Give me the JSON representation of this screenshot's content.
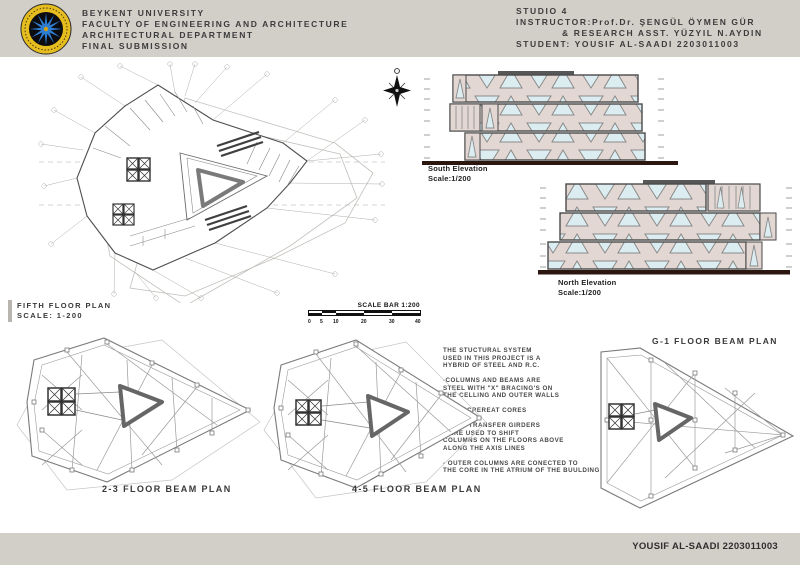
{
  "header": {
    "logo_name": "beykent-university-seal",
    "university": "BEYKENT UNIVERSITY",
    "faculty": "FACULTY OF ENGINEERING AND ARCHITECTURE",
    "department": "ARCHITECTURAL DEPARTMENT",
    "submission": "FINAL SUBMISSION",
    "studio": "STUDIO 4",
    "instructor": "INSTRUCTOR:Prof.Dr. ŞENGÜL ÖYMEN GÜR",
    "instructor_assistant": "& RESEARCH ASST. YÜZYIL N.AYDIN",
    "student": "STUDENT: YOUSIF AL-SAADI 2203011003"
  },
  "drawings": {
    "floor_plan": {
      "title": "FIFTH FLOOR PLAN",
      "scale": "SCALE: 1-200"
    },
    "south_elevation": {
      "title": "South Elevation",
      "scale": "Scale:1/200"
    },
    "north_elevation": {
      "title": "North Elevation",
      "scale": "Scale:1/200"
    },
    "beam_plan_23": {
      "title": "2-3 FLOOR BEAM PLAN"
    },
    "beam_plan_45": {
      "title": "4-5 FLOOR BEAM PLAN"
    },
    "beam_plan_g1": {
      "title": "G-1 FLOOR BEAM PLAN"
    }
  },
  "scale_bar": {
    "title": "SCALE BAR 1:200",
    "ticks": [
      "0",
      "5",
      "10",
      "20",
      "30",
      "40"
    ]
  },
  "notes": {
    "structural_system": "THE STUCTURAL SYSTEM\nUSED IN THIS PROJECT IS A\nHYBRID OF STEEL AND R.C.\n\n-COLUMNS AND BEAMS ARE\nSTEEL WITH \"X\" BRACING'S ON\nTHE CELLING AND OUTER WALLS\n\n-2 CONCREREAT CORES\n\n- DEEP TRANSFER GIRDERS\nWERE USED TO SHIFT\nCOLUMNS ON THE FLOORS ABOVE\nALONG THE AXIS LINES\n\n- OUTER COLUMNS ARE CONECTED TO\nTHE CORE IN THE ATRIUM OF THE BUULDING"
  },
  "footer": {
    "credit": "YOUSIF AL-SAADI 2203011003"
  },
  "colors": {
    "band_gray": "#d2cfc9",
    "wall_fill": "#e2d7d2",
    "glass_fill": "#dcedf2",
    "ground_line": "#2c1710",
    "logo_gold": "#e6bd1f",
    "logo_star_blue": "#2d7ed2"
  }
}
